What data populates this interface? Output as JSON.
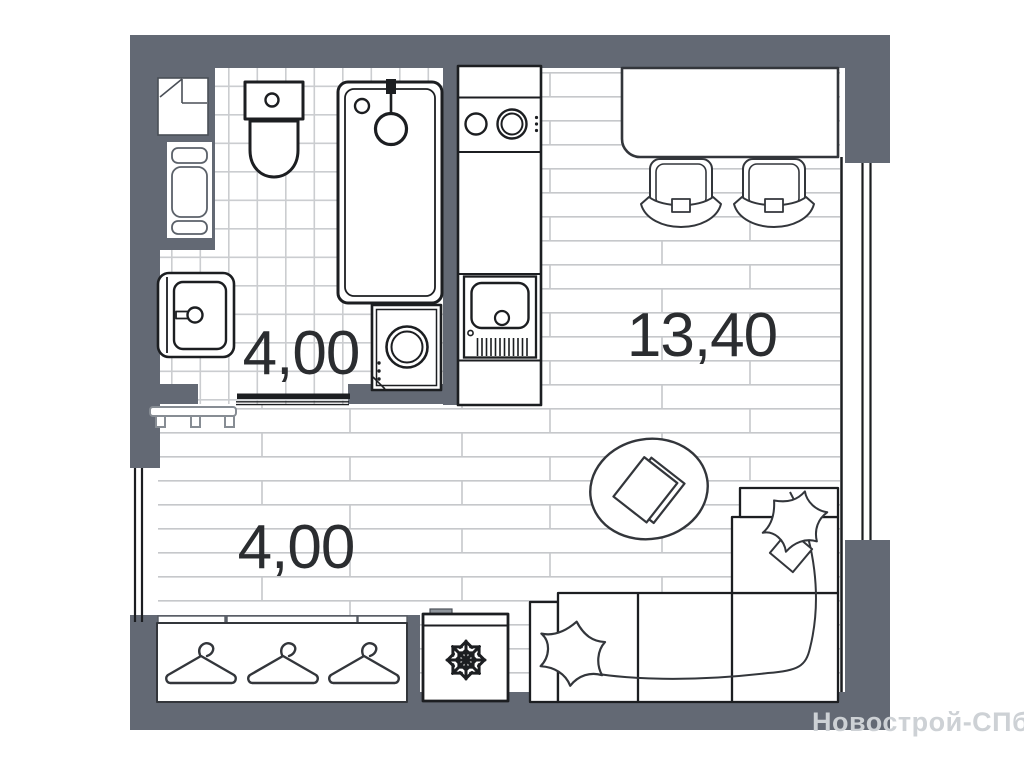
{
  "watermark": {
    "text": "Новострой-СПб"
  },
  "rooms": {
    "bathroom": {
      "name": "bathroom",
      "area_label": "4,00"
    },
    "living_kitchen": {
      "name": "living-kitchen-room",
      "area_label": "13,40"
    },
    "hall": {
      "name": "hall",
      "area_label": "4,00"
    }
  },
  "fixtures": [
    "vent-shaft",
    "pipe-riser",
    "toilet",
    "bathtub",
    "shower-head",
    "washing-machine",
    "bathroom-sink",
    "sliding-door",
    "kitchen-counter",
    "stove",
    "kitchen-sink",
    "bar-table",
    "bar-stool-left",
    "bar-stool-right",
    "window",
    "entrance-door",
    "bench",
    "rug",
    "book",
    "corner-sofa",
    "pillow-left",
    "pillow-chaise",
    "fridge",
    "snowflake-icon",
    "wardrobe",
    "hanger-1",
    "hanger-2",
    "hanger-3"
  ],
  "colors": {
    "paper": "#ffffff",
    "wall": "#636974",
    "outline": "#1c1e21",
    "furniture_line": "#33363b",
    "tile_line": "#cbcdd0",
    "plank_line": "#c6c8cb",
    "bench_line": "#878d94",
    "label_text": "#2b2d30",
    "watermark_text": "#cdd1d5"
  }
}
